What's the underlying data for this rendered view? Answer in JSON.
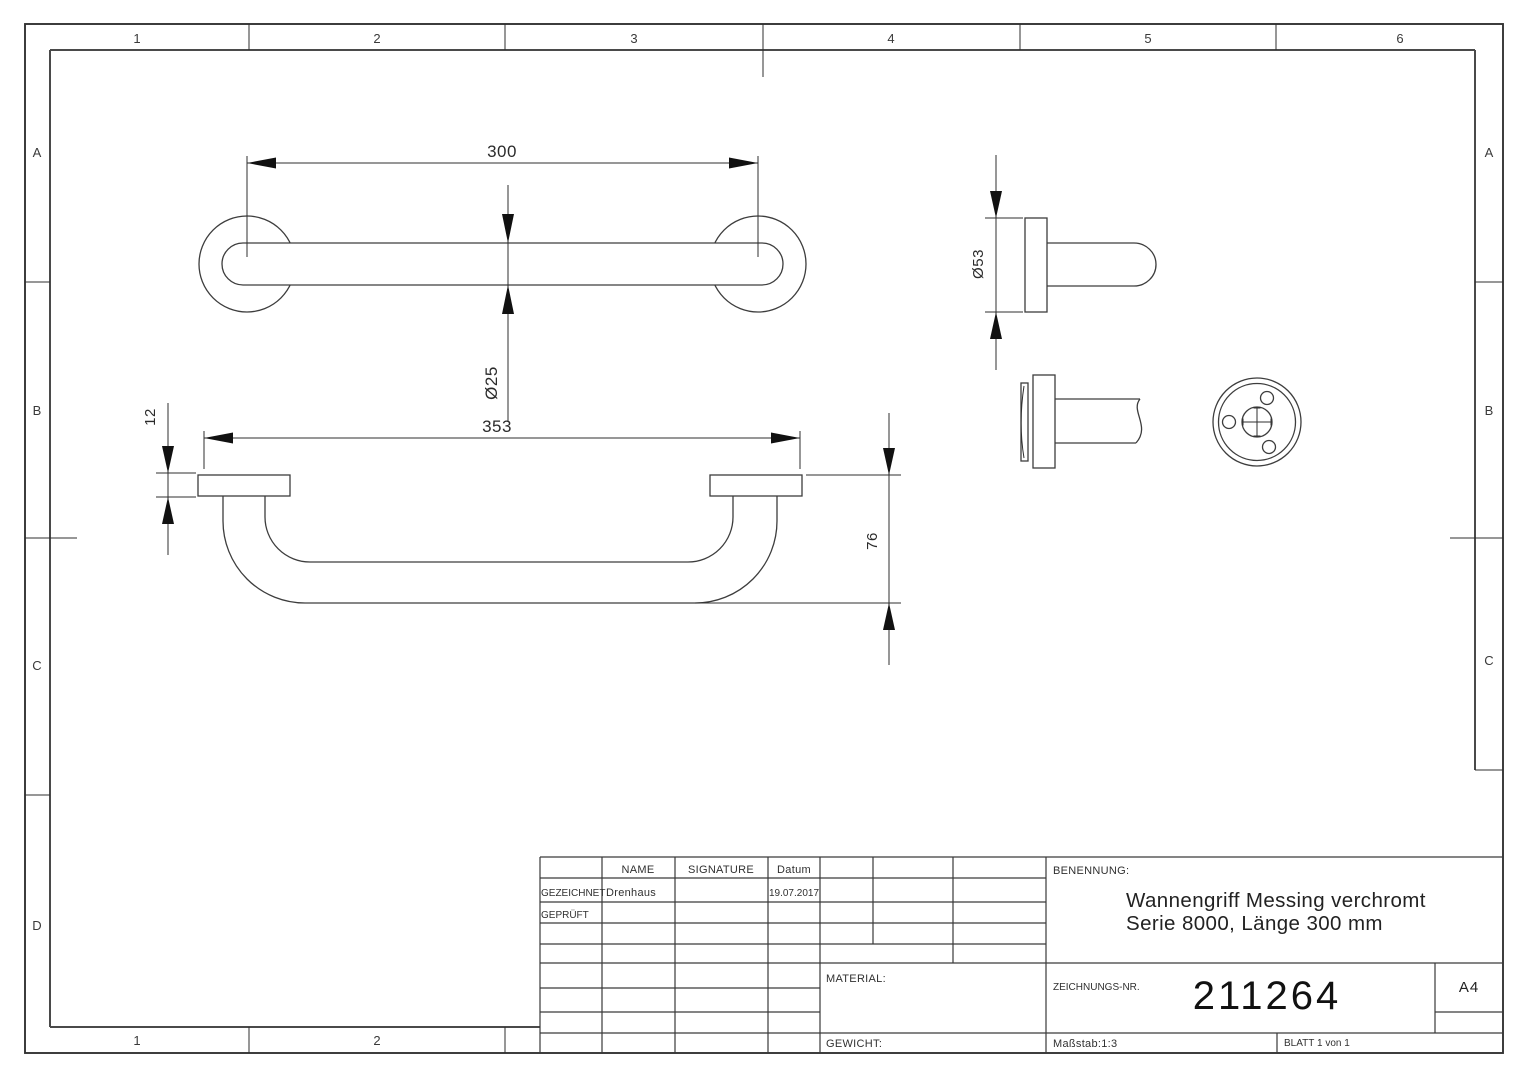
{
  "sheet": {
    "zones": {
      "top": [
        "1",
        "2",
        "3",
        "4",
        "5",
        "6"
      ],
      "bottom": [
        "1",
        "2"
      ],
      "left": [
        "A",
        "B",
        "C",
        "D"
      ],
      "right": [
        "A",
        "B",
        "C"
      ]
    }
  },
  "dimensions": {
    "top_view_length": "300",
    "top_view_diameter": "Ø25",
    "front_view_length": "353",
    "front_view_plate_height": "12",
    "front_view_depth": "76",
    "side_view_flange_diameter": "Ø53"
  },
  "title_block": {
    "col_name": "NAME",
    "col_signature": "SIGNATURE",
    "col_date": "Datum",
    "row_drawn_label": "GEZEICHNET",
    "row_drawn_name": "Drenhaus",
    "row_drawn_date": "19.07.2017",
    "row_checked_label": "GEPRÜFT",
    "material_label": "MATERIAL:",
    "weight_label": "GEWICHT:",
    "benennung_label": "BENENNUNG:",
    "title_line1": "Wannengriff Messing verchromt",
    "title_line2": "Serie 8000, Länge 300 mm",
    "drawing_no_label": "ZEICHNUNGS-NR.",
    "drawing_no": "211264",
    "paper_format": "A4",
    "scale": "Maßstab:1:3",
    "sheet_info": "BLATT 1 von 1"
  }
}
